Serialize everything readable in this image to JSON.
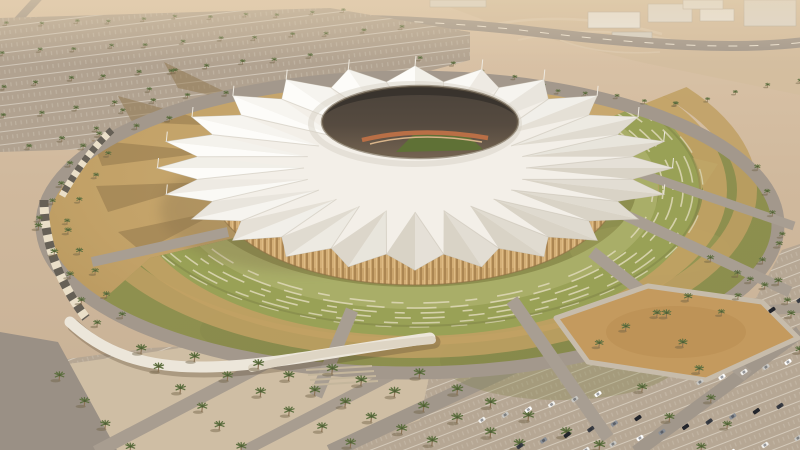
{
  "scene": {
    "title": "Aerial architectural rendering of a desert stadium with a white tensile crown roof, ringed by green terraces and palm-lined parking lots"
  },
  "palette": {
    "desert_top": "#dcc5a9",
    "desert_mid": "#d0b99d",
    "desert_low": "#c7b095",
    "asphalt": "#b1a290",
    "asphalt_warm": "#b6a794",
    "road": "#a3988c",
    "road_dash": "#ece3d3",
    "plaza_tan": "#c2a167",
    "lawn": "#8e904f",
    "terrace_green": "#99a156",
    "terrace_light": "#a9ae68",
    "terrace_stripe": "#dbd6b4",
    "terrace_tan": "#bfa063",
    "timber": "#c9a36b",
    "pitch_green": "#5f7136",
    "track_orange": "#b96f46",
    "ramp_white": "#ece6da",
    "sand_plot": "#c49a5e",
    "road_ring": "#a3988c"
  },
  "roof": {
    "cx": 415,
    "cy": 168,
    "rx": 222,
    "ry": 88,
    "peaks": 24,
    "peak": 1.16,
    "valley": 0.985,
    "inner": 0.5,
    "light_angle": 225,
    "base": "#f3efe8",
    "face_light": "#fdfcf9",
    "face_shade": "#d9d3c6",
    "crease": "#c5beb0",
    "edge": "#c8c1b3",
    "mast": "#eee9df"
  },
  "opening": {
    "cx": 420,
    "cy": 122,
    "rx": 98,
    "ry": 36
  },
  "buildings": [
    {
      "x": 588,
      "y": 12,
      "w": 52,
      "h": 16,
      "c": "#eae6de"
    },
    {
      "x": 648,
      "y": 4,
      "w": 44,
      "h": 18,
      "c": "#e2ddd4"
    },
    {
      "x": 700,
      "y": 9,
      "w": 34,
      "h": 12,
      "c": "#eae6de"
    },
    {
      "x": 744,
      "y": 0,
      "w": 52,
      "h": 26,
      "c": "#ded8ce"
    },
    {
      "x": 612,
      "y": 32,
      "w": 40,
      "h": 7,
      "c": "#d7d1c6"
    },
    {
      "x": 683,
      "y": 0,
      "w": 40,
      "h": 9,
      "c": "#e6e1d8"
    },
    {
      "x": 430,
      "y": 0,
      "w": 56,
      "h": 7,
      "c": "#dfd9cf"
    }
  ],
  "palms": {
    "rows": [
      {
        "f": [
          8,
          26
        ],
        "t": [
          345,
          13
        ],
        "n": 11,
        "s": 0.5,
        "l": "far"
      },
      {
        "f": [
          2,
          55
        ],
        "t": [
          400,
          30
        ],
        "n": 12,
        "s": 0.55,
        "l": "far"
      },
      {
        "f": [
          2,
          88
        ],
        "t": [
          310,
          58
        ],
        "n": 10,
        "s": 0.6,
        "l": "far"
      },
      {
        "f": [
          4,
          118
        ],
        "t": [
          225,
          94
        ],
        "n": 7,
        "s": 0.62,
        "l": "far"
      },
      {
        "f": [
          28,
          148
        ],
        "t": [
          170,
          122
        ],
        "n": 5,
        "s": 0.68,
        "l": "far"
      },
      {
        "f": [
          98,
          132
        ],
        "t": [
          172,
          72
        ],
        "n": 4,
        "s": 0.6,
        "l": "far"
      },
      {
        "f": [
          420,
          60
        ],
        "t": [
          545,
          86
        ],
        "n": 5,
        "s": 0.55,
        "l": "far"
      },
      {
        "f": [
          556,
          92
        ],
        "t": [
          676,
          106
        ],
        "n": 5,
        "s": 0.55,
        "l": "far"
      },
      {
        "f": [
          676,
          106
        ],
        "t": [
          798,
          82
        ],
        "n": 5,
        "s": 0.55,
        "l": "far"
      },
      {
        "f": [
          82,
          148
        ],
        "t": [
          40,
          222
        ],
        "n": 5,
        "s": 0.72,
        "l": "near"
      },
      {
        "f": [
          40,
          230
        ],
        "t": [
          96,
          326
        ],
        "n": 5,
        "s": 0.85,
        "l": "near"
      },
      {
        "f": [
          108,
          156
        ],
        "t": [
          66,
          224
        ],
        "n": 4,
        "s": 0.68,
        "l": "near"
      },
      {
        "f": [
          66,
          232
        ],
        "t": [
          122,
          318
        ],
        "n": 5,
        "s": 0.8,
        "l": "near"
      },
      {
        "f": [
          758,
          170
        ],
        "t": [
          782,
          238
        ],
        "n": 4,
        "s": 0.7,
        "l": "near"
      },
      {
        "f": [
          778,
          246
        ],
        "t": [
          722,
          316
        ],
        "n": 5,
        "s": 0.78,
        "l": "near"
      },
      {
        "f": [
          668,
          318
        ],
        "t": [
          726,
          428
        ],
        "n": 5,
        "s": 1.0,
        "l": "near"
      },
      {
        "f": [
          778,
          284
        ],
        "t": [
          800,
          352
        ],
        "n": 3,
        "s": 0.9,
        "l": "near"
      },
      {
        "f": [
          640,
          390
        ],
        "t": [
          700,
          452
        ],
        "n": 3,
        "s": 1.1,
        "l": "near"
      },
      {
        "f": [
          60,
          380
        ],
        "t": [
          130,
          452
        ],
        "n": 4,
        "s": 1.1,
        "l": "near"
      },
      {
        "f": [
          140,
          352
        ],
        "t": [
          240,
          450
        ],
        "n": 6,
        "s": 1.15,
        "l": "near"
      },
      {
        "f": [
          196,
          362
        ],
        "t": [
          352,
          448
        ],
        "n": 6,
        "s": 1.15,
        "l": "near"
      },
      {
        "f": [
          258,
          368
        ],
        "t": [
          430,
          446
        ],
        "n": 7,
        "s": 1.2,
        "l": "near"
      },
      {
        "f": [
          330,
          372
        ],
        "t": [
          520,
          448
        ],
        "n": 7,
        "s": 1.25,
        "l": "near"
      },
      {
        "f": [
          420,
          378
        ],
        "t": [
          600,
          450
        ],
        "n": 6,
        "s": 1.25,
        "l": "near"
      },
      {
        "f": [
          598,
          346
        ],
        "t": [
          686,
          300
        ],
        "n": 4,
        "s": 0.95,
        "l": "near"
      },
      {
        "f": [
          712,
          262
        ],
        "t": [
          788,
          302
        ],
        "n": 4,
        "s": 0.8,
        "l": "near"
      }
    ]
  },
  "cars": {
    "angle": -35,
    "colors": [
      "#f2f1ee",
      "#3a3d44",
      "#c9c8c4",
      "#8a8f96",
      "#ffffff",
      "#23252b"
    ],
    "rows": [
      {
        "f": [
          482,
          420
        ],
        "t": [
          598,
          394
        ],
        "n": 6
      },
      {
        "f": [
          520,
          446
        ],
        "t": [
          638,
          418
        ],
        "n": 6
      },
      {
        "f": [
          700,
          382
        ],
        "t": [
          788,
          362
        ],
        "n": 5
      },
      {
        "f": [
          662,
          432
        ],
        "t": [
          780,
          406
        ],
        "n": 6
      },
      {
        "f": [
          732,
          452
        ],
        "t": [
          798,
          438
        ],
        "n": 3
      },
      {
        "f": [
          772,
          310
        ],
        "t": [
          800,
          300
        ],
        "n": 2
      },
      {
        "f": [
          586,
          450
        ],
        "t": [
          640,
          438
        ],
        "n": 3
      }
    ]
  }
}
